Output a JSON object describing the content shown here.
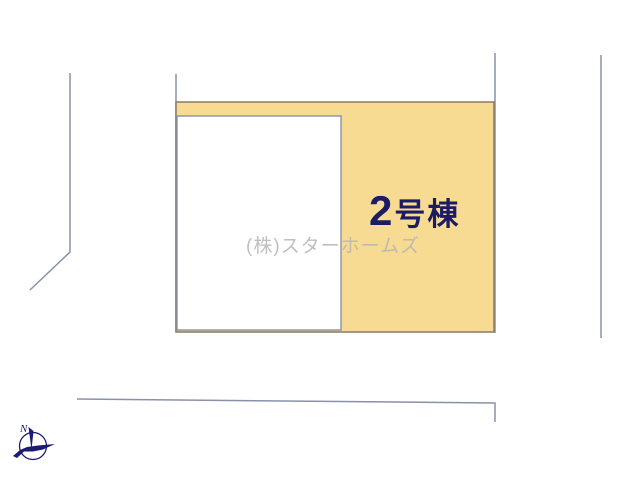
{
  "diagram": {
    "plot": {
      "number": "2",
      "suffix": "号棟",
      "full_label": "2号棟"
    },
    "watermark": "(株)スターホームズ",
    "compass": {
      "north": "N"
    }
  },
  "colors": {
    "plot_fill": "#f8db93",
    "plot_border": "#8a7a68",
    "building_fill": "#ffffff",
    "building_border": "#8b90a6",
    "boundary_line": "#8a90a8",
    "label_text": "#1b1b66",
    "watermark_text": "#b5b5b5",
    "compass": "#1b1b74"
  }
}
